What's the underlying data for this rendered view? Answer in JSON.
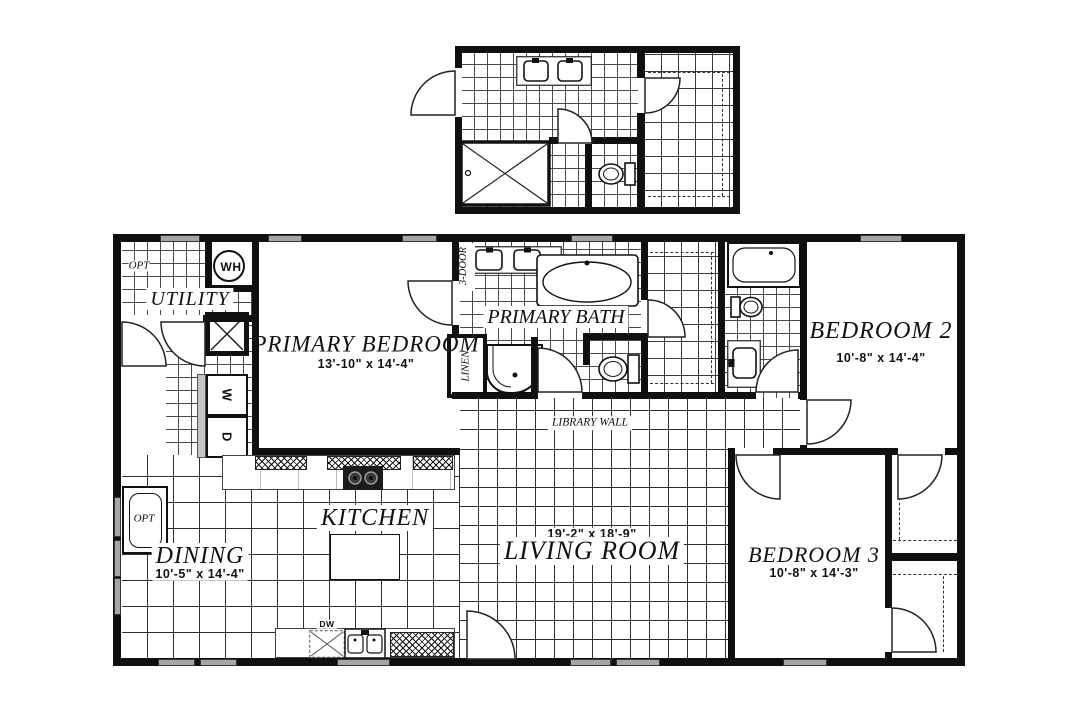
{
  "rooms": {
    "utility": {
      "name": "UTILITY"
    },
    "primary_bedroom": {
      "name": "PRIMARY BEDROOM",
      "dims": "13'-10\" x 14'-4\""
    },
    "primary_bath": {
      "name": "PRIMARY BATH"
    },
    "bedroom2": {
      "name": "BEDROOM 2",
      "dims": "10'-8\" x 14'-4\""
    },
    "kitchen": {
      "name": "KITCHEN"
    },
    "dining": {
      "name": "DINING",
      "dims": "10'-5\" x 14'-4\""
    },
    "living_room": {
      "name": "LIVING ROOM",
      "dims": "19'-2\" x 18'-9\""
    },
    "bedroom3": {
      "name": "BEDROOM 3",
      "dims": "10'-8\" x 14'-3\""
    }
  },
  "labels": {
    "water_heater": "WH",
    "washer": "W",
    "dryer": "D",
    "optional_upper": "OPT",
    "optional_lower": "OPT",
    "linen": "LINEN",
    "three_door": "3-DOOR",
    "library_wall": "LIBRARY WALL",
    "dishwasher": "DW"
  }
}
